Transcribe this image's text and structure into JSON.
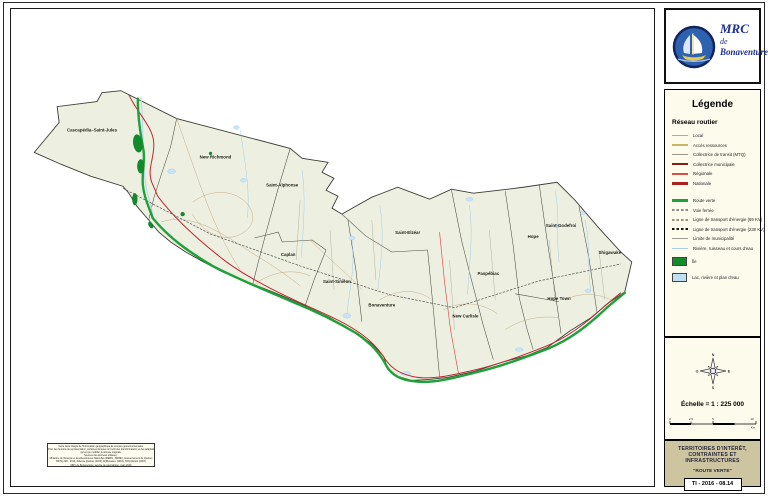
{
  "logo": {
    "line1": "MRC",
    "line2": "de",
    "line3": "Bonaventure",
    "brand_blue": "#1a2f8f"
  },
  "legend": {
    "title": "Légende",
    "section_road": "Réseau routier",
    "road_items": [
      {
        "label": "Local",
        "color": "#b3ab9e"
      },
      {
        "label": "Accès ressources",
        "color": "#c6b468"
      },
      {
        "label": "Collectrice de transit (MTQ)",
        "color": "#9b958a"
      },
      {
        "label": "Collectrice municipale",
        "color": "#7e2418"
      },
      {
        "label": "Régionale",
        "color": "#d94f45"
      },
      {
        "label": "Nationale",
        "color": "#a8201f"
      }
    ],
    "other_items": [
      {
        "label": "Route verte",
        "color": "#1fa13a"
      },
      {
        "label": "Voie ferrée",
        "color": "#8a8a8a"
      },
      {
        "label": "Ligne de transport d'énergie (69 KV)",
        "color": "#a09276"
      },
      {
        "label": "Ligne de transport d'énergie (230 KV)",
        "color": "#1a1a1a"
      },
      {
        "label": "Limite de municipalité",
        "color": "#9a9a92"
      },
      {
        "label": "Rivière, ruisseau et cours d'eau",
        "color": "#a9cfe8"
      }
    ],
    "area_items": [
      {
        "label": "Île",
        "color": "#138a2b"
      },
      {
        "label": "Lac, rivière et plan d'eau",
        "color": "#bfdff5"
      }
    ]
  },
  "scale": {
    "text": "Échelle = 1 : 225 000",
    "compass": [
      "N",
      "E",
      "S",
      "O"
    ],
    "bar_labels": [
      "0",
      "2,5",
      "5",
      "10"
    ],
    "unit": "Km"
  },
  "title_block": {
    "line1": "TERRITOIRES D'INTÉRÊT,",
    "line2": "CONTRAINTES ET INFRASTRUCTURES",
    "line3": "\"ROUTE VERTE\"",
    "code": "TI - 2016 - 08.14"
  },
  "map": {
    "labels": [
      {
        "text": "Cascapédia–Saint-Jules"
      },
      {
        "text": "New Richmond"
      },
      {
        "text": "Saint-Alphonse"
      },
      {
        "text": "Saint-Elzéar"
      },
      {
        "text": "Caplan"
      },
      {
        "text": "Saint-Siméon"
      },
      {
        "text": "Bonaventure"
      },
      {
        "text": "New Carlisle"
      },
      {
        "text": "Paspébiac"
      },
      {
        "text": "Hope"
      },
      {
        "text": "Saint-Godefroi"
      },
      {
        "text": "Shigawake"
      },
      {
        "text": "Hope Town"
      }
    ]
  },
  "fineprint": {
    "lines": [
      "Cette carte intègre de l'information géographique de sources gouvernementales.",
      "Pour des besoins de représentation, certaines données ont subi des transformations et des adaptations",
      "qui ont pu modifier la donnée originale.",
      "Sources des données utilisées :",
      "Ministère de l'Énergie et des Ressources Naturelles (MERN - MRNF), Gouvernement du Québec",
      "BDTQ 20K - 2010, Adresse Québec (2016), AQRéseau+ (2016), Orthophotos (2016)",
      "MRC de Bonaventure, service de géomatique, mars 2016"
    ]
  }
}
